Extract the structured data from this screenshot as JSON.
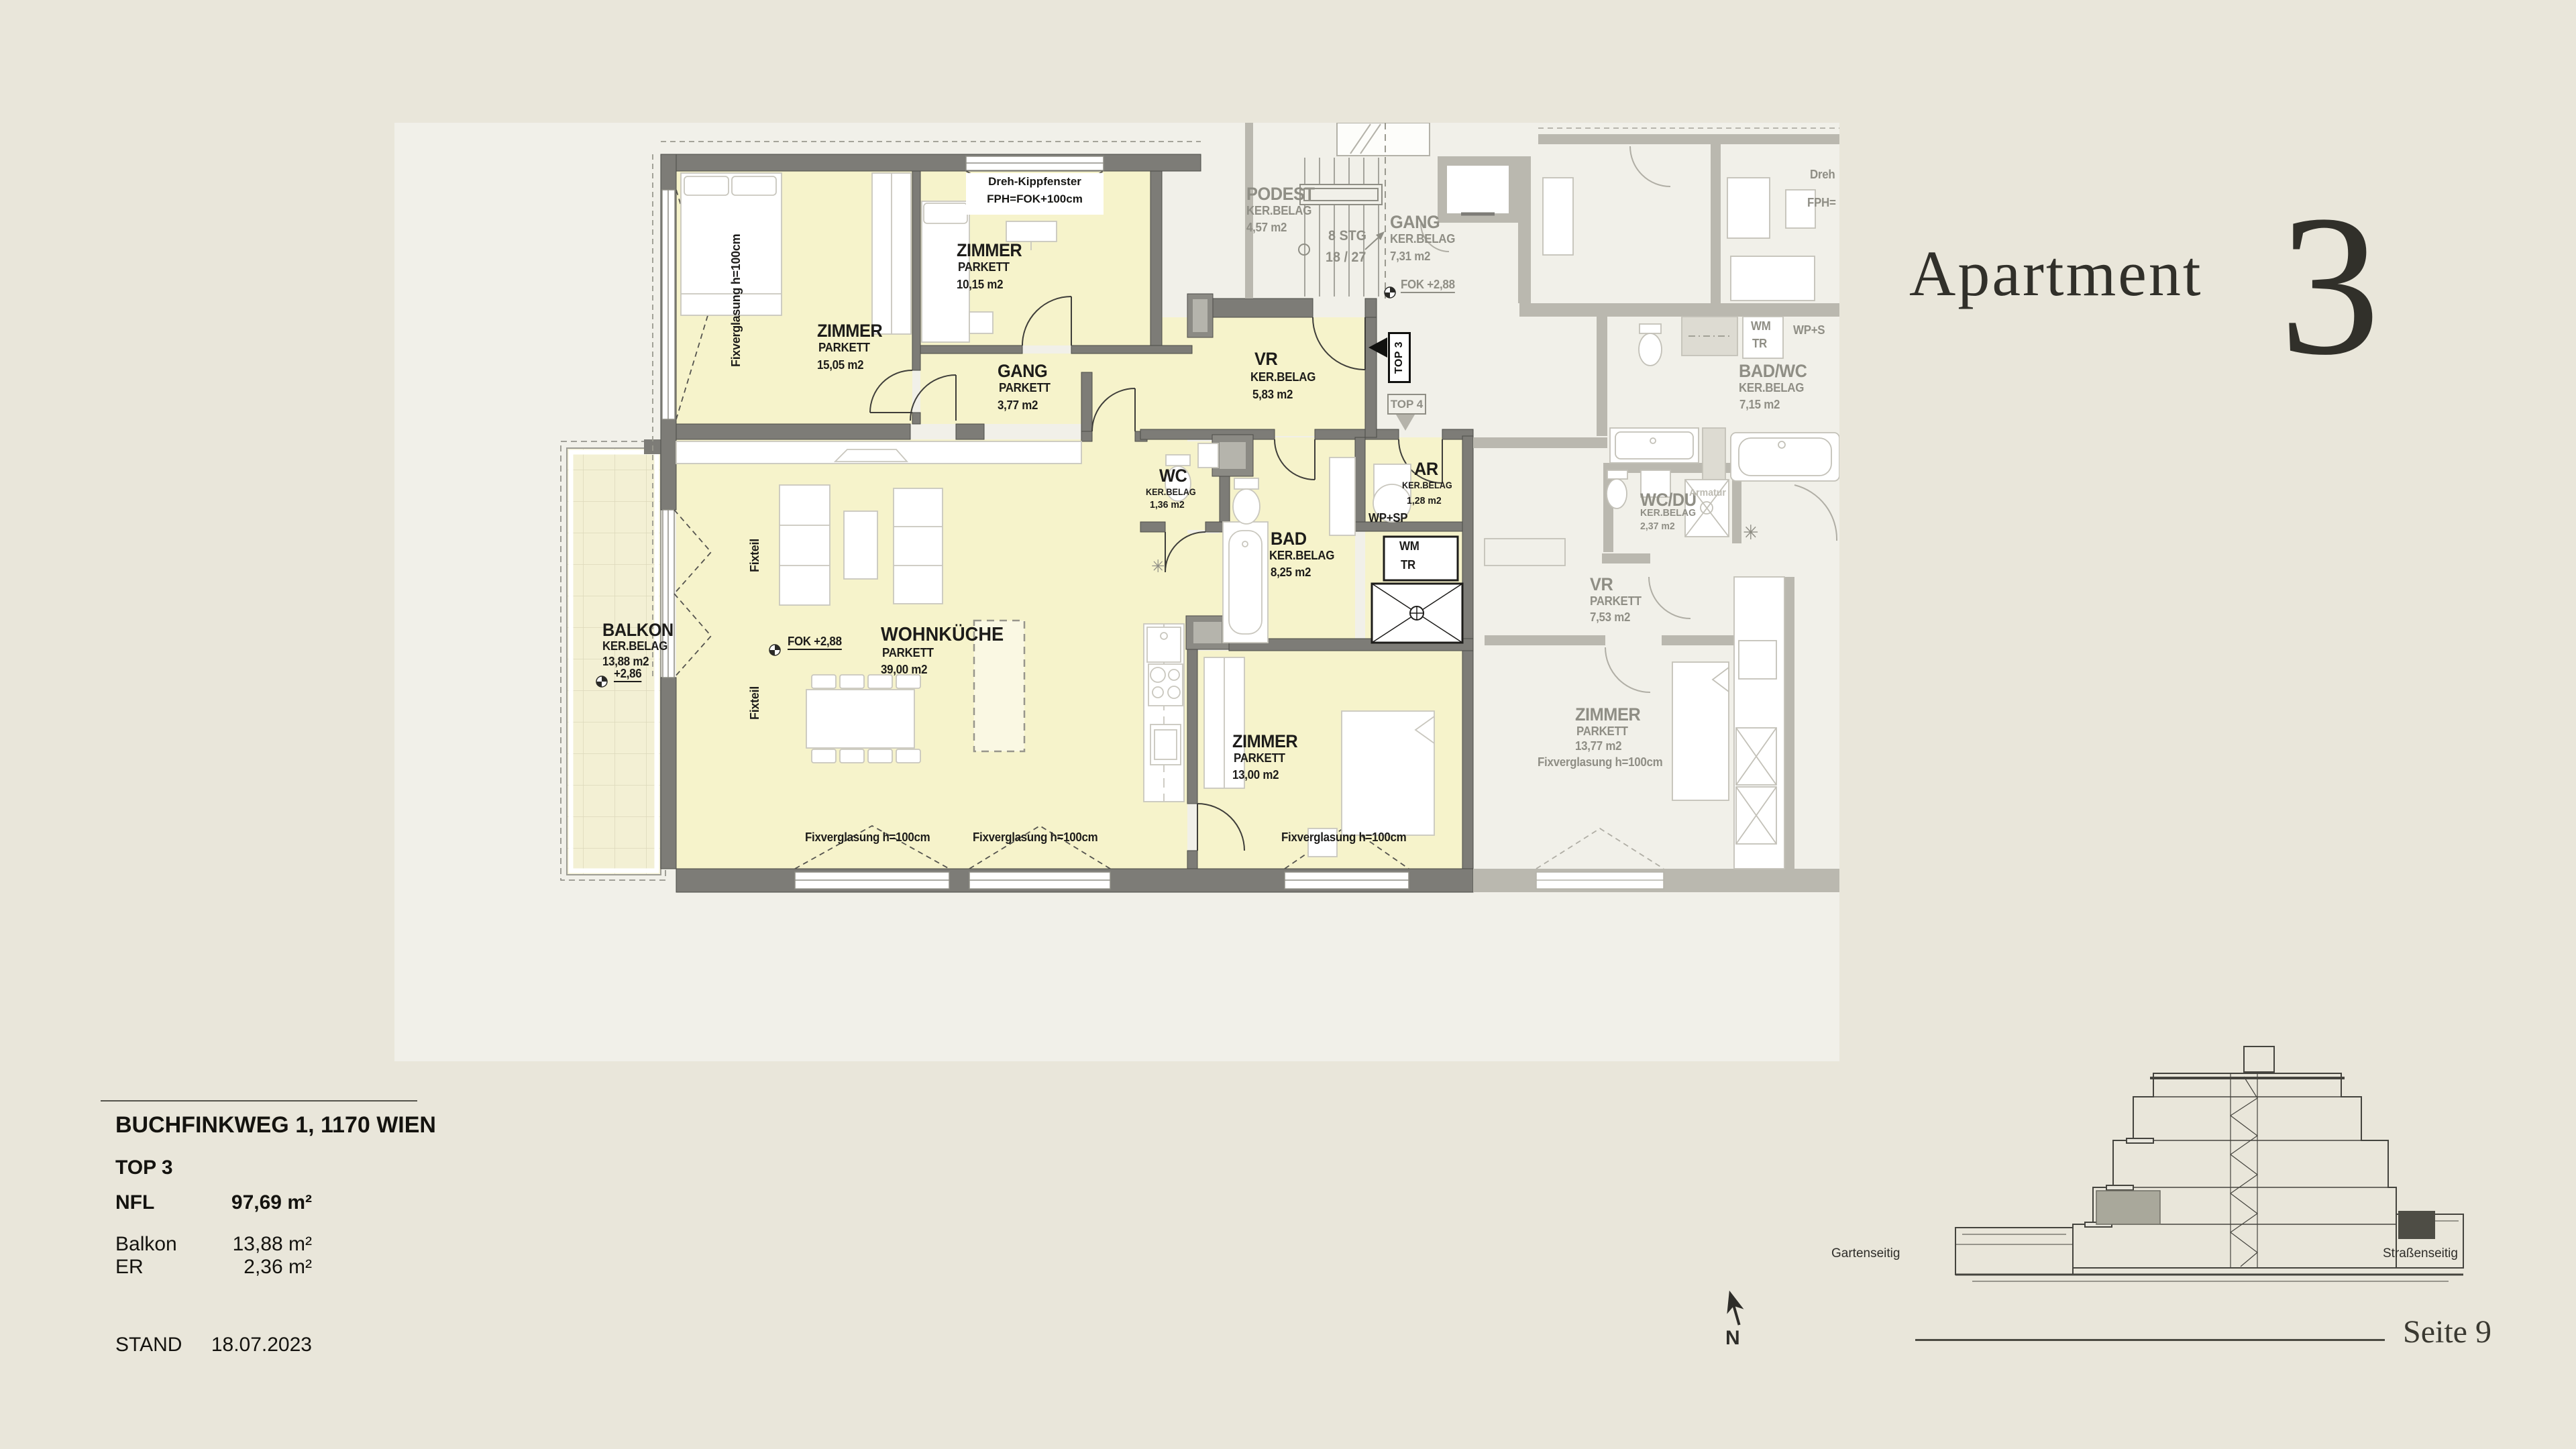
{
  "colors": {
    "page_bg": "#e9e6da",
    "panel_bg": "#f1f0e9",
    "room_yellow": "#f6f3cb",
    "wall_dark": "#7d7c77",
    "wall_gray": "#bab8af",
    "text_gray": "#8f8e85",
    "ink": "#1d1c1a"
  },
  "header": {
    "title": "Apartment",
    "number": "3"
  },
  "plan": {
    "top3": {
      "zimmer1": {
        "name": "ZIMMER",
        "floor": "PARKETT",
        "area": "15,05 m2"
      },
      "zimmer2": {
        "name": "ZIMMER",
        "floor": "PARKETT",
        "area": "10,15 m2"
      },
      "gang": {
        "name": "GANG",
        "floor": "PARKETT",
        "area": "3,77 m2"
      },
      "vr": {
        "name": "VR",
        "floor": "KER.BELAG",
        "area": "5,83 m2"
      },
      "wc": {
        "name": "WC",
        "floor": "KER.BELAG",
        "area": "1,36 m2"
      },
      "bad": {
        "name": "BAD",
        "floor": "KER.BELAG",
        "area": "8,25 m2"
      },
      "ar": {
        "name": "AR",
        "floor": "KER.BELAG",
        "area": "1,28 m2"
      },
      "wohnkueche": {
        "name": "WOHNKÜCHE",
        "floor": "PARKETT",
        "area": "39,00 m2"
      },
      "zimmer3": {
        "name": "ZIMMER",
        "floor": "PARKETT",
        "area": "13,00 m2"
      },
      "balkon": {
        "name": "BALKON",
        "floor": "KER.BELAG",
        "area": "13,88 m2",
        "level": "+2,86"
      },
      "fok": "FOK +2,88",
      "wm": "WM",
      "tr": "TR",
      "wp_sp": "WP+SP",
      "entry_marker": "TOP 3",
      "window_note_line1": "Dreh-Kippfenster",
      "window_note_line2": "FPH=FOK+100cm",
      "fixverglasung": "Fixverglasung h=100cm",
      "fixteil": "Fixteil"
    },
    "common": {
      "podest": {
        "name": "PODEST",
        "floor": "KER.BELAG",
        "area": "4,57 m2"
      },
      "stairs_line1": "8 STG",
      "stairs_line2": "18 / 27",
      "gang": {
        "name": "GANG",
        "floor": "KER.BELAG",
        "area": "7,31 m2"
      },
      "fok": "FOK +2,88",
      "top4_marker": "TOP 4"
    },
    "top4": {
      "badwc": {
        "name": "BAD/WC",
        "floor": "KER.BELAG",
        "area": "7,15 m2"
      },
      "wcdu": {
        "name": "WC/DU",
        "floor": "KER.BELAG",
        "area": "2,37 m2"
      },
      "vr": {
        "name": "VR",
        "floor": "PARKETT",
        "area": "7,53 m2"
      },
      "zimmer": {
        "name": "ZIMMER",
        "floor": "PARKETT",
        "area": "13,77 m2"
      },
      "wm": "WM",
      "tr": "TR",
      "wp_s": "WP+S",
      "armatur": "Armatur",
      "fixverglasung": "Fixverglasung h=100cm",
      "cut_label_line1": "Dreh",
      "cut_label_line2": "FPH="
    }
  },
  "info_panel": {
    "address": "BUCHFINKWEG 1, 1170 WIEN",
    "unit": "TOP 3",
    "rows": [
      {
        "label": "NFL",
        "value": "97,69 m²"
      },
      {
        "label": "Balkon",
        "value": "13,88 m²"
      },
      {
        "label": "ER",
        "value": "2,36 m²"
      }
    ],
    "stand_label": "STAND",
    "stand_value": "18.07.2023"
  },
  "section": {
    "garden_label": "Gartenseitig",
    "street_label": "Straßenseitig"
  },
  "compass": {
    "label": "N"
  },
  "footer": {
    "page_label": "Seite 9"
  }
}
